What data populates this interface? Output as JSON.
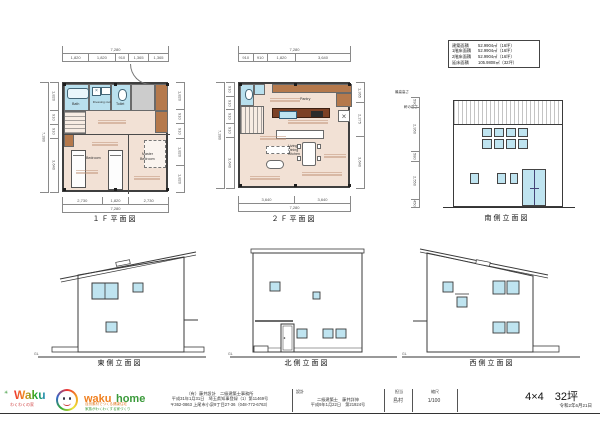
{
  "sheet": {
    "project": "4×4　32坪",
    "date": "令和2年6月21日",
    "gl_label": "GL"
  },
  "logo": {
    "waku": "Waku",
    "waku_sub": "わくわくの家",
    "home_waku": "waku",
    "home_home": "home",
    "tagline1": "自然素材でつくる健康住宅",
    "tagline2": "家族がわくわくする家づくり"
  },
  "office": {
    "line1": "（有）藤井設計　二級建築士事務所",
    "line2": "平成31年1月31日　埼玉県知事登録（1）第11469号",
    "line3": "〒362-0863 上尾市小泉9丁目27-36（048-772-6763）"
  },
  "titleblock": {
    "design_label": "設計",
    "design_line1": "二級建築士　藤井詳伸",
    "design_line2": "平成9年1月22日　第21924号",
    "staff_label": "担当",
    "staff_value": "島村",
    "scale_label": "縮尺",
    "scale_value": "1/100"
  },
  "area_table": {
    "rows": [
      {
        "label": "建築面積",
        "value": "52.9904㎡（16坪）"
      },
      {
        "label": "1階床面積",
        "value": "52.9904㎡（16坪）"
      },
      {
        "label": "2階床面積",
        "value": "52.9904㎡（16坪）"
      },
      {
        "label": "延床面積",
        "value": "105.9808㎡（32坪）"
      }
    ]
  },
  "plan1f": {
    "title": "１Ｆ平面図",
    "dim_top_total": "7,280",
    "dims_top": [
      "1,820",
      "1,820",
      "910",
      "1,365",
      "1,365"
    ],
    "dim_left_total": "7,280",
    "dims_left": [
      "1,820",
      "910",
      "910",
      "3,640"
    ],
    "dims_right": [
      "1,820",
      "910",
      "910",
      "1,820",
      "1,820"
    ],
    "dims_bottom": [
      "2,730",
      "1,820",
      "2,730"
    ],
    "dim_bottom_total": "7,280",
    "rooms": {
      "bath": "Bath",
      "dressing": "Dressing room",
      "toilet": "Toilet",
      "bedroom": "Bedroom",
      "master1": "Master",
      "master2": "Bedroom"
    }
  },
  "plan2f": {
    "title": "２Ｆ平面図",
    "dim_top_total": "7,280",
    "dims_top": [
      "910",
      "910",
      "1,820",
      "3,640"
    ],
    "dim_left_total": "7,280",
    "dims_left": [
      "910",
      "910",
      "910",
      "910",
      "3,640"
    ],
    "dims_right": [
      "1,365",
      "2,275",
      "3,640"
    ],
    "dims_bottom": [
      "3,640",
      "3,640"
    ],
    "dim_bottom_total": "7,280",
    "rooms": {
      "pantry": "Pantry",
      "ldk1": "Living",
      "ldk2": "Dining",
      "ldk3": "Kitchen"
    }
  },
  "elev_south": {
    "title": "南側立面図",
    "label_max": "最高高さ",
    "label_eave": "軒の高さ",
    "dims": [
      "590",
      "2,950",
      "580",
      "2,550",
      "450"
    ]
  },
  "elev_east": {
    "title": "東側立面図"
  },
  "elev_north": {
    "title": "北側立面図"
  },
  "elev_west": {
    "title": "西側立面図"
  }
}
